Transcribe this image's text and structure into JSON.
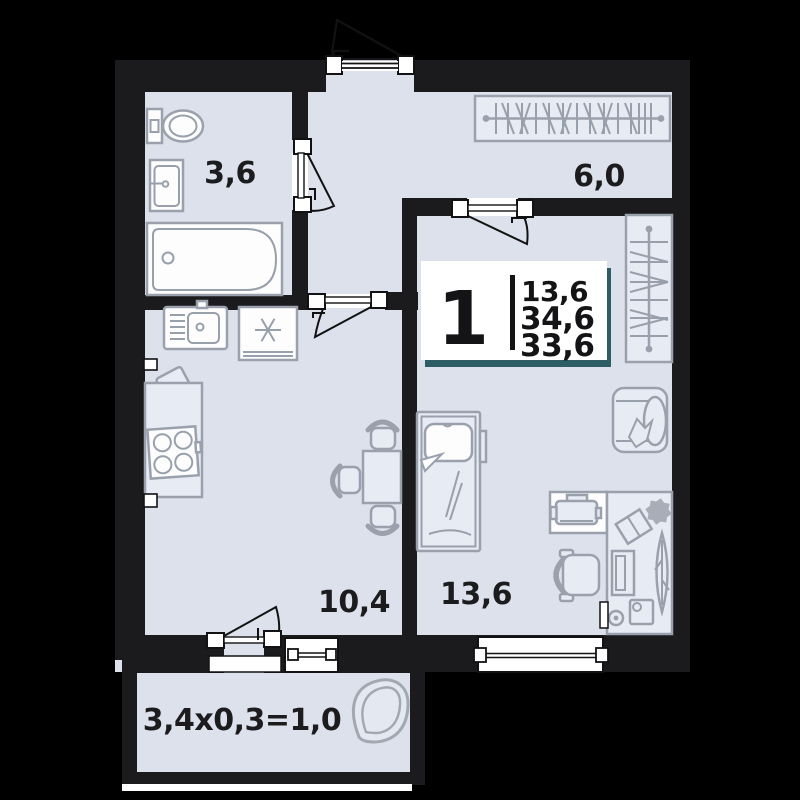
{
  "title": "1-room apartment floor plan",
  "legend": {
    "rooms_count": "1",
    "area_line1": "13,6",
    "area_line2": "34,6",
    "area_line3": "33,6"
  },
  "rooms": {
    "bathroom": {
      "name": "bathroom",
      "area": "3,6"
    },
    "hallway": {
      "name": "hallway",
      "area": "6,0"
    },
    "kitchen": {
      "name": "kitchen-living-room",
      "area": "10,4"
    },
    "bedroom": {
      "name": "bedroom",
      "area": "13,6"
    },
    "balcony": {
      "name": "balcony",
      "area": "3,4x0,3=1,0"
    }
  },
  "furniture_icons": [
    "toilet",
    "washbasin",
    "bathtub",
    "coat-rack",
    "wardrobe-hangers",
    "kitchen-sink",
    "refrigerator",
    "stove",
    "counter",
    "cutting-board",
    "dining-table",
    "chair",
    "bed",
    "armchair",
    "desk",
    "printer",
    "office-chair",
    "sideboard",
    "plant",
    "leaf-plant",
    "balcony-chair"
  ],
  "colors": {
    "background": "#000000",
    "wall": "#1b1b1d",
    "floor": "#dce1eb",
    "furniture_fill": "#e7ebf3",
    "fixture_white": "#ffffff",
    "outline_gray": "#9aa1ad",
    "door_line": "#121214",
    "label_text": "#1c1c1e",
    "legend_shadow": "#2d5e66"
  }
}
